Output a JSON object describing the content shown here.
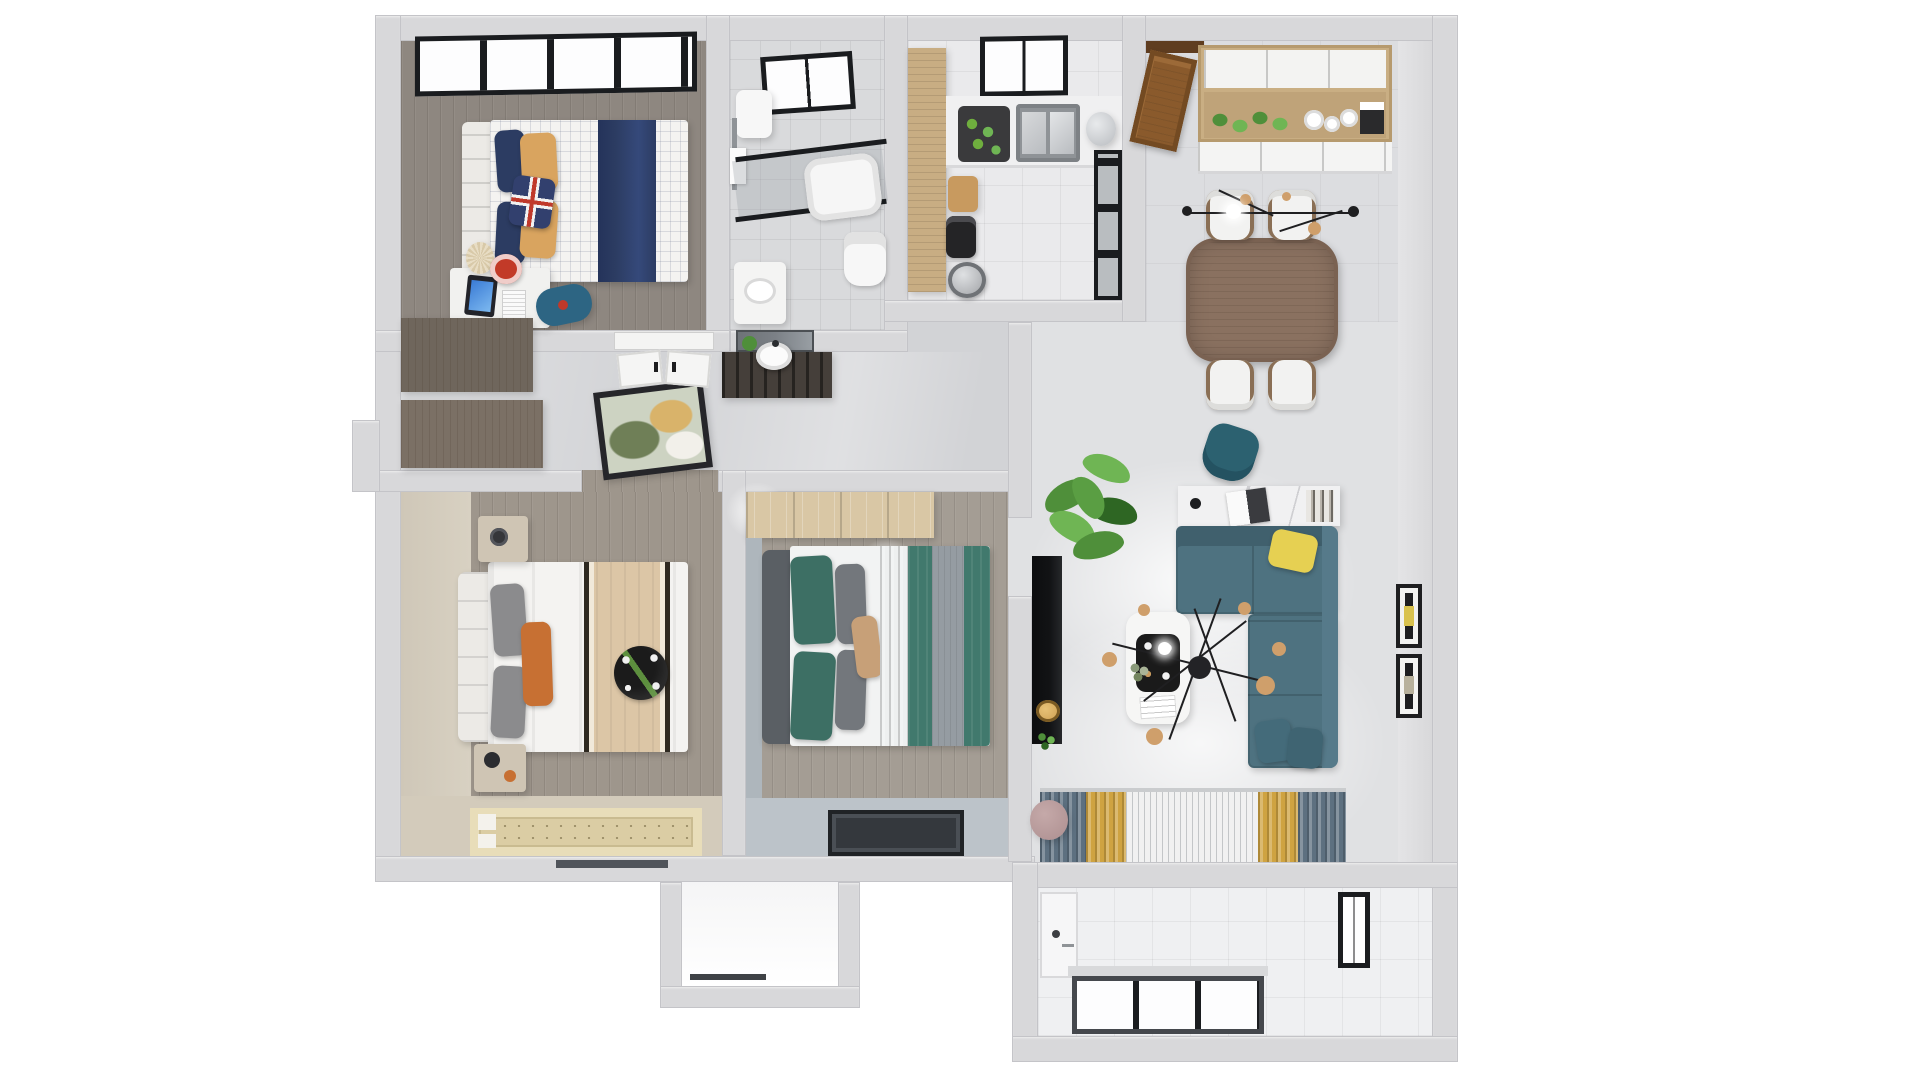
{
  "scene": {
    "description": "3D rendered top-down floor plan of a two-bedroom apartment, photorealistic dollhouse view on a white background",
    "view": "top-down axonometric architectural render",
    "visible_text": "none",
    "background": "#ffffff"
  },
  "rooms": [
    {
      "id": "bedroom-kids",
      "position": "top-left",
      "items": [
        "black-framed-window",
        "single-bed-plaid-duvet",
        "navy-blanket",
        "navy-pillows",
        "tan-pillows",
        "union-jack-pillow",
        "white-slat-headboard",
        "study-desk",
        "monitor",
        "keyboard",
        "red-desk-chair",
        "pleated-table-lamp",
        "blue-bean-bag",
        "wood-dresser"
      ]
    },
    {
      "id": "bathroom",
      "position": "top-center-left",
      "items": [
        "skylight-window",
        "water-heater",
        "towel-rack",
        "glass-shower-partition",
        "bathtub",
        "toilet",
        "vanity-sink"
      ]
    },
    {
      "id": "kitchen",
      "position": "top-center-right",
      "items": [
        "wood-pantry-cabinet",
        "black-framed-window",
        "counter",
        "double-steel-sink",
        "vegetable-basket",
        "kettle",
        "cutting-board",
        "coffee-machine",
        "cooking-pot",
        "dark-glass-door"
      ]
    },
    {
      "id": "dining-room",
      "position": "top-right",
      "items": [
        "wood-entry-door",
        "wall-cabinets-wood-white",
        "hanging-green-plants",
        "white-dishes",
        "wood-dining-table",
        "white-dining-chairs-x4",
        "linear-chandelier"
      ]
    },
    {
      "id": "hallway",
      "position": "center",
      "items": [
        "leaning-artwork",
        "white-entry-doors",
        "dark-washstand-console",
        "round-basin",
        "mirror",
        "ceiling-light-glows",
        "closet-cabinets"
      ]
    },
    {
      "id": "master-bedroom",
      "position": "bottom-left",
      "items": [
        "tufted-white-headboard",
        "double-bed-white-duvet",
        "gray-pillows",
        "orange-pillow",
        "beige-blanket-black-trim",
        "black-decor-plate",
        "nightstands-x2",
        "tatami-rug",
        "beige-accent-walls"
      ]
    },
    {
      "id": "bedroom-teal",
      "position": "bottom-center",
      "items": [
        "light-wood-wardrobe",
        "gray-upholstered-headboard",
        "teal-pillows",
        "gray-pillows",
        "tan-pillow",
        "teal-duvet",
        "gray-bed-runner",
        "low-dark-window-panel"
      ]
    },
    {
      "id": "living-room",
      "position": "right",
      "items": [
        "wall-tv-panel",
        "gold-pendant-lamp",
        "large-potted-plant",
        "teal-desk-chair",
        "marble-console-desk",
        "laptop",
        "books",
        "teal-sectional-sofa",
        "yellow-pillow",
        "white-coffee-table",
        "black-decor-tray",
        "sputnik-chandelier",
        "sheer-curtains",
        "gold-drapes",
        "slate-drapes",
        "round-side-table",
        "wall-frames"
      ]
    },
    {
      "id": "balcony-laundry",
      "position": "bottom-right",
      "items": [
        "white-tile-floor",
        "laundry-cabinet",
        "side-window",
        "dark-framed-sliding-windows"
      ]
    },
    {
      "id": "utility-bump-out",
      "position": "bottom-center",
      "items": [
        "empty-white-floor"
      ]
    }
  ],
  "colors": {
    "wall": "#d8d8da",
    "wallShade": "#c4c4c8",
    "wallFace": "#e4e4e6",
    "floorKids": "#8e8780",
    "floorMaster": "#9e968c",
    "floorTeal": "#a49d94",
    "beigeWall": "#cfc7b8",
    "beigeFloor": "#d3cbbb",
    "hallFloor": "#d2d3d6",
    "livingFloor": "#e0e1e3",
    "kitchenFloor": "#eaeaec",
    "bathFloor": "#d9dadc",
    "diningFloor": "#dcdde0",
    "balconyFloor": "#eff0f2",
    "bumpFloor": "#f5f5f6",
    "navy": "#2c3c62",
    "tanPillow": "#d9a45f",
    "unionRed": "#c0392b",
    "unionBlue": "#32406e",
    "screenBlue": "#3a7bd5",
    "chairRed": "#c23a28",
    "beanbagBlue": "#2d6583",
    "cream": "#e8ddc4",
    "deskWhite": "#f1f1ef",
    "duvetWhite": "#f4f3f1",
    "woodDresserA": "#6f665c",
    "woodDresserB": "#7b7065",
    "steel": "#b9bcc0",
    "steelDark": "#8f9397",
    "basketDark": "#3a3a3c",
    "veggieGreen": "#6fae3e",
    "woodPantry": "#c8ad83",
    "boardTan": "#c89a5f",
    "applianceBlack": "#242426",
    "doorBrown": "#8a5a2c",
    "cabinetWood": "#c9ae83",
    "cabinetShelf": "#bfa379",
    "plantGreen": "#4f8f3a",
    "plantGreenLight": "#6fb554",
    "plantGreenDark": "#2e6623",
    "tableWood": "#8a7160",
    "chairWhite": "#f2f2f1",
    "chairLegBrown": "#8a6f55",
    "chandBlack": "#1f1f21",
    "chandGold": "#cf9f6b",
    "artFrame": "#26262a",
    "consoleDark": "#453f3a",
    "mirrorGray": "#7b8086",
    "headboardWhite": "#eceae6",
    "grayPillow": "#8b8b8d",
    "orangePillow": "#c77033",
    "blanketTan": "#dcc6a6",
    "trimDark": "#2e2921",
    "plateBlack": "#1b1b1b",
    "nightstand": "#cfc5b4",
    "rugBorder": "#e8ddb9",
    "rugCenter": "#dbcda4",
    "wardrobeWood": "#d9c7a5",
    "headboardGray": "#5a5f64",
    "tealPillow": "#3d6f64",
    "tealDuvet": "#41796d",
    "runnerGray": "#959ca2",
    "sheetWhite": "#f2f3f3",
    "bandBlueGray": "#bcc3c9",
    "panelDark": "#34383d",
    "tvBlack": "#121315",
    "pendantGold": "#c99a4e",
    "sofaTeal": "#4e7280",
    "sofaBack": "#40606d",
    "sofaArm": "#567a8a",
    "yellowPillow": "#e6d052",
    "marbleWhite": "#f1f1f2",
    "marbleVein": "#cfcfd2",
    "tableWhite": "#f6f6f5",
    "trayBlack": "#1a1a1a",
    "goldCurtain": "#cfa341",
    "slateCurtain": "#5d7080",
    "sheerWhite": "#f1f1f1",
    "sideTablePink": "#ad8f90",
    "frameBlack": "#1e1e20",
    "frameYellow": "#d9c24e",
    "washerWhite": "#f6f6f7",
    "windowFrame": "#45484d",
    "glassWhite": "#fdfdfe",
    "skylightFrame": "#1a1c1f"
  }
}
